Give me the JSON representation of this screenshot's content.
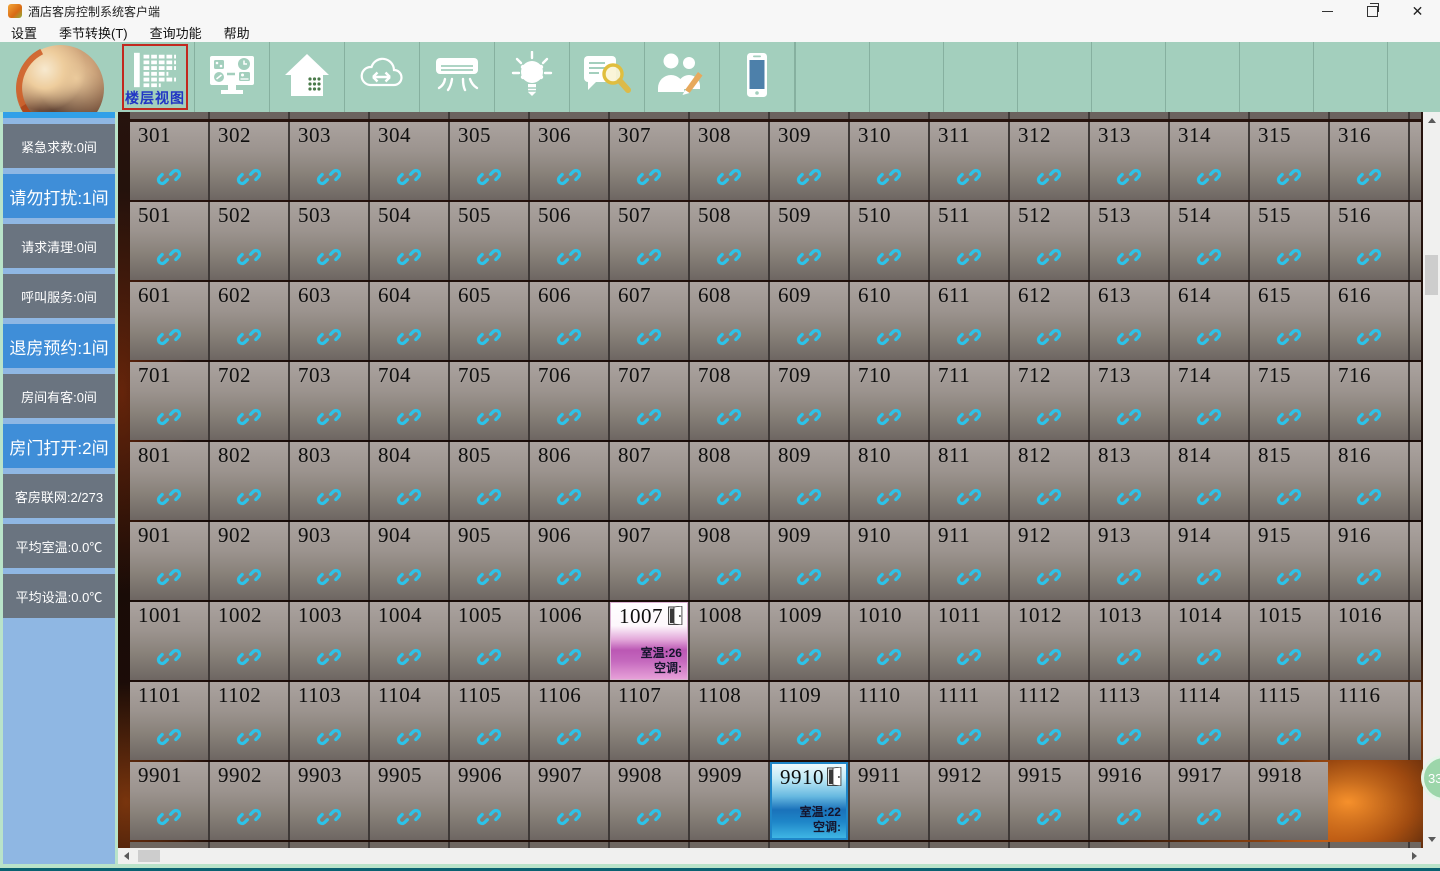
{
  "window": {
    "title": "酒店客房控制系统客户端"
  },
  "menu": {
    "items": [
      "设置",
      "季节转换(T)",
      "查询功能",
      "帮助"
    ]
  },
  "toolbar": {
    "active_tool_label": "楼层视图",
    "icons": [
      "floor-view-icon",
      "monitor-settings-icon",
      "house-rooms-icon",
      "cloud-sync-icon",
      "air-conditioner-icon",
      "light-bulb-icon",
      "message-search-icon",
      "staff-edit-icon",
      "mobile-phone-icon"
    ]
  },
  "sidebar": {
    "items": [
      {
        "label": "紧急求救:0间",
        "variant": "gray"
      },
      {
        "label": "请勿打扰:1间",
        "variant": "blue"
      },
      {
        "label": "请求清理:0间",
        "variant": "gray"
      },
      {
        "label": "呼叫服务:0间",
        "variant": "gray"
      },
      {
        "label": "退房预约:1间",
        "variant": "blue"
      },
      {
        "label": "房间有客:0间",
        "variant": "gray"
      },
      {
        "label": "房门打开:2间",
        "variant": "blue"
      },
      {
        "label": "客房联网:2/273",
        "variant": "gray"
      },
      {
        "label": "平均室温:0.0℃",
        "variant": "gray"
      },
      {
        "label": "平均设温:0.0℃",
        "variant": "gray"
      }
    ]
  },
  "grid": {
    "rows": [
      {
        "rooms": [
          "301",
          "302",
          "303",
          "304",
          "305",
          "306",
          "307",
          "308",
          "309",
          "310",
          "311",
          "312",
          "313",
          "314",
          "315",
          "316"
        ],
        "sliver": true
      },
      {
        "rooms": [
          "501",
          "502",
          "503",
          "504",
          "505",
          "506",
          "507",
          "508",
          "509",
          "510",
          "511",
          "512",
          "513",
          "514",
          "515",
          "516"
        ],
        "sliver": true
      },
      {
        "rooms": [
          "601",
          "602",
          "603",
          "604",
          "605",
          "606",
          "607",
          "608",
          "609",
          "610",
          "611",
          "612",
          "613",
          "614",
          "615",
          "616"
        ],
        "sliver": true
      },
      {
        "rooms": [
          "701",
          "702",
          "703",
          "704",
          "705",
          "706",
          "707",
          "708",
          "709",
          "710",
          "711",
          "712",
          "713",
          "714",
          "715",
          "716"
        ],
        "sliver": true
      },
      {
        "rooms": [
          "801",
          "802",
          "803",
          "804",
          "805",
          "806",
          "807",
          "808",
          "809",
          "810",
          "811",
          "812",
          "813",
          "814",
          "815",
          "816"
        ],
        "sliver": true
      },
      {
        "rooms": [
          "901",
          "902",
          "903",
          "904",
          "905",
          "906",
          "907",
          "908",
          "909",
          "910",
          "911",
          "912",
          "913",
          "914",
          "915",
          "916"
        ],
        "sliver": true
      },
      {
        "rooms": [
          "1001",
          "1002",
          "1003",
          "1004",
          "1005",
          "1006",
          "1007",
          "1008",
          "1009",
          "1010",
          "1011",
          "1012",
          "1013",
          "1014",
          "1015",
          "1016"
        ],
        "sliver": true
      },
      {
        "rooms": [
          "1101",
          "1102",
          "1103",
          "1104",
          "1105",
          "1106",
          "1107",
          "1108",
          "1109",
          "1110",
          "1111",
          "1112",
          "1113",
          "1114",
          "1115",
          "1116"
        ],
        "sliver": true
      },
      {
        "rooms": [
          "9901",
          "9902",
          "9903",
          "9905",
          "9906",
          "9907",
          "9908",
          "9909",
          "9910",
          "9911",
          "9912",
          "9915",
          "9916",
          "9917",
          "9918"
        ],
        "sliver": false
      }
    ],
    "special_rooms": {
      "1007": {
        "temp_label": "室温:26",
        "ac_label": "空调:",
        "style": "pink"
      },
      "9910": {
        "temp_label": "室温:22",
        "ac_label": "空调:",
        "style": "blue"
      }
    }
  },
  "badge": {
    "text": "33"
  },
  "colors": {
    "toolbar": "#a3cfbd",
    "sidebar_gray": "#6a7480",
    "sidebar_blue": "#3f8ed8",
    "link_icon": "#2cc3e9",
    "special_pink": "#bb57b4",
    "special_blue": "#1a72ba"
  }
}
